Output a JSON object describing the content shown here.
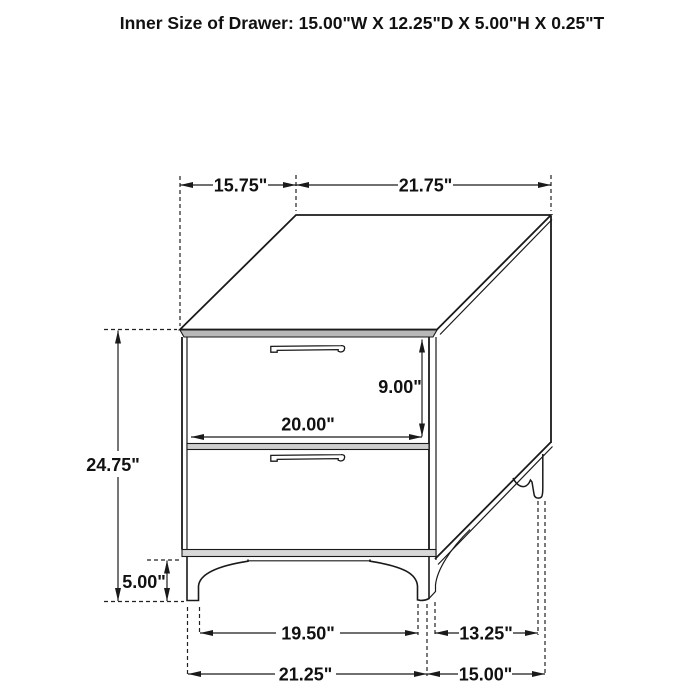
{
  "title": "Inner Size of Drawer: 15.00\"W X 12.25\"D X 5.00\"H X 0.25\"T",
  "diagram": {
    "type": "furniture-dimension-drawing",
    "object": "two-drawer nightstand line drawing",
    "dimensions": {
      "top_depth": "15.75\"",
      "top_width": "21.75\"",
      "overall_height": "24.75\"",
      "drawer_front_height": "9.00\"",
      "drawer_front_width": "20.00\"",
      "leg_height": "5.00\"",
      "front_leg_inner_span": "19.50\"",
      "side_leg_span": "13.25\"",
      "base_front_width": "21.25\"",
      "base_side_depth": "15.00\""
    },
    "colors": {
      "line": "#1a1a1a",
      "top_edge_band": "#b8b8b8",
      "divider_band": "#cfcfcf",
      "bottom_band": "#d8d8d8",
      "background": "#ffffff"
    }
  }
}
